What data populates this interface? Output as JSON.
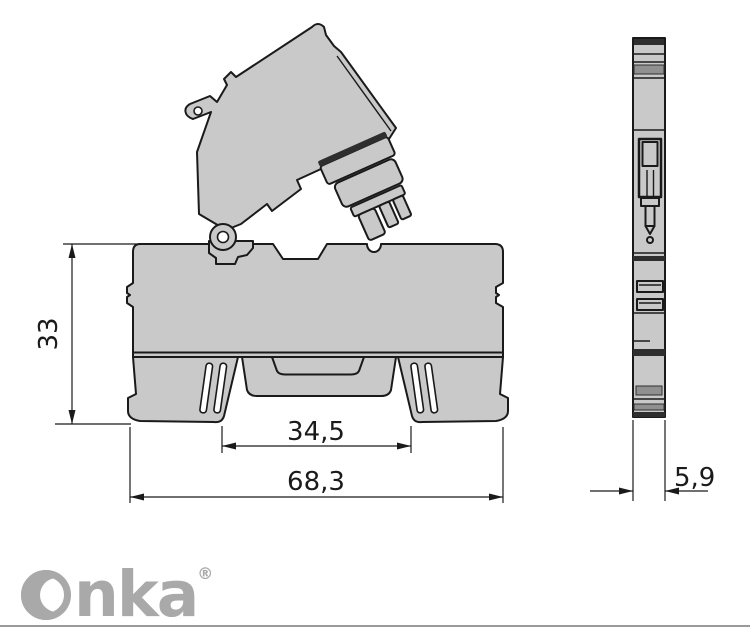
{
  "drawing": {
    "type": "technical-dimension-drawing",
    "subject": "DIN-rail fuse terminal block, side view with open fuse lever and end view",
    "dimensions": {
      "height_mm": "33",
      "rail_width_mm": "34,5",
      "overall_width_mm": "68,3",
      "depth_mm": "5,9"
    },
    "colors": {
      "body_fill": "#c9c9c9",
      "outline": "#1a1a1a",
      "dark_detail": "#2e2e2e",
      "mid_detail": "#909090",
      "dimension_text": "#1a1a1a"
    }
  },
  "logo": {
    "brand_text": "nka",
    "registered_mark": "®",
    "color": "#a9a9a9"
  }
}
